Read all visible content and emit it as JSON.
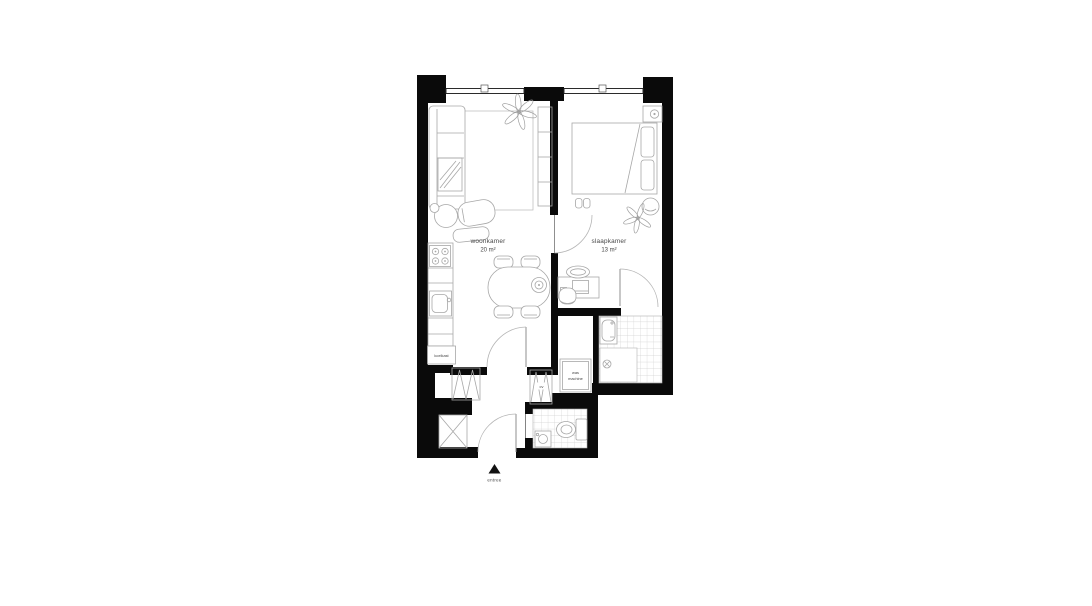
{
  "floorplan": {
    "rooms": [
      {
        "id": "living",
        "name": "woonkamer",
        "area": "20 m²"
      },
      {
        "id": "bedroom",
        "name": "slaapkamer",
        "area": "13 m²"
      }
    ],
    "labels": {
      "fridge": "koelkast",
      "washer_line1": "was",
      "washer_line2": "machine",
      "cv": "cv",
      "entrance": "entree"
    },
    "colors": {
      "wall": "#0a0a0a",
      "furniture_line": "#a7a7a7",
      "tile_line": "#cfcfcf",
      "label_text": "#474747",
      "background": "#ffffff"
    }
  }
}
